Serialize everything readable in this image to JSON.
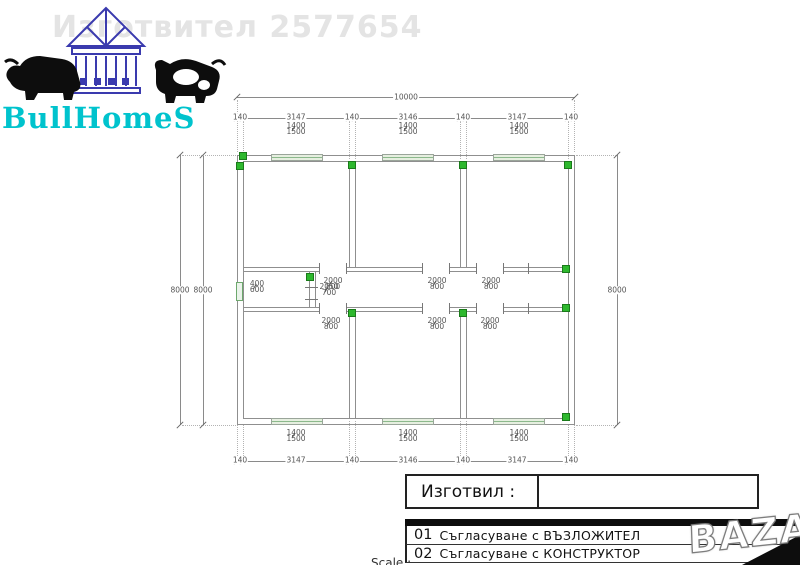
{
  "watermarks": {
    "maker": "Изготвител 2577654",
    "bazar": "BAZAR"
  },
  "logo": {
    "brand": "BullHomeS"
  },
  "dims": {
    "total": "10000",
    "seg": [
      "140",
      "3147",
      "140",
      "3146",
      "140",
      "3147",
      "140"
    ],
    "side_outer": "8000",
    "side_inner": "8000",
    "side_right": "8000",
    "win_w": "1400",
    "win_h": "1500",
    "lwin_w": "400",
    "lwin_h": "600",
    "door_w": "2000",
    "door_h": "800",
    "door2_w": "2050",
    "door2_h": "700"
  },
  "titleblock": {
    "author_label": "Изготвил :",
    "rows": [
      {
        "num": "01",
        "label": "Съгласуване с ВЪЗЛОЖИТЕЛ"
      },
      {
        "num": "02",
        "label": "Съгласуване с КОНСТРУКТОР"
      }
    ],
    "scale_label": "Scale :"
  },
  "colors": {
    "accent_green": "#2eb82e",
    "window_green": "#8cb98c",
    "logo_teal": "#00c3cd",
    "logo_blue": "#3a3aae",
    "wall_gray": "#8f8f8f"
  }
}
